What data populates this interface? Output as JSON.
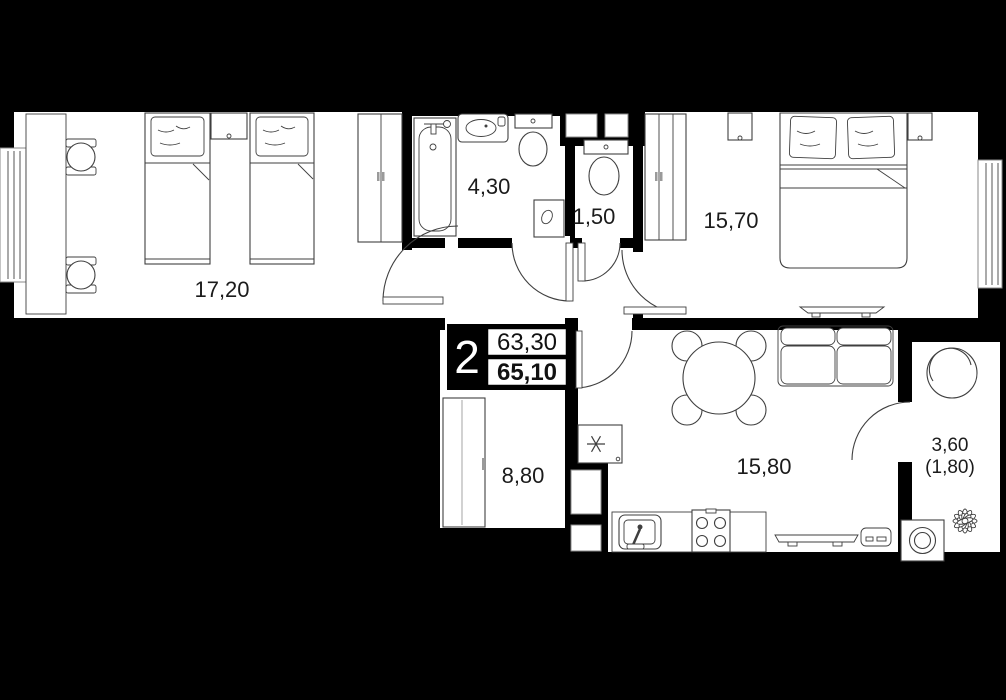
{
  "plan": {
    "title": "2-room apartment floor plan",
    "type_badge": {
      "rooms_count": "2",
      "area_living": "63,30",
      "area_total": "65,10"
    },
    "rooms": [
      {
        "id": "twin-bedroom",
        "area_label": "17,20"
      },
      {
        "id": "bathroom",
        "area_label": "4,30"
      },
      {
        "id": "wc",
        "area_label": "1,50"
      },
      {
        "id": "master-bedroom",
        "area_label": "15,70"
      },
      {
        "id": "hallway",
        "area_label": "8,80"
      },
      {
        "id": "kitchen-living",
        "area_label": "15,80"
      },
      {
        "id": "balcony",
        "area_label": "3,60",
        "area_label_secondary": "(1,80)"
      }
    ],
    "colors": {
      "background": "#000000",
      "walls": "#000000",
      "floor": "#ffffff",
      "furniture_stroke": "#3f3f3f",
      "label_text": "#1b1b1b"
    }
  }
}
